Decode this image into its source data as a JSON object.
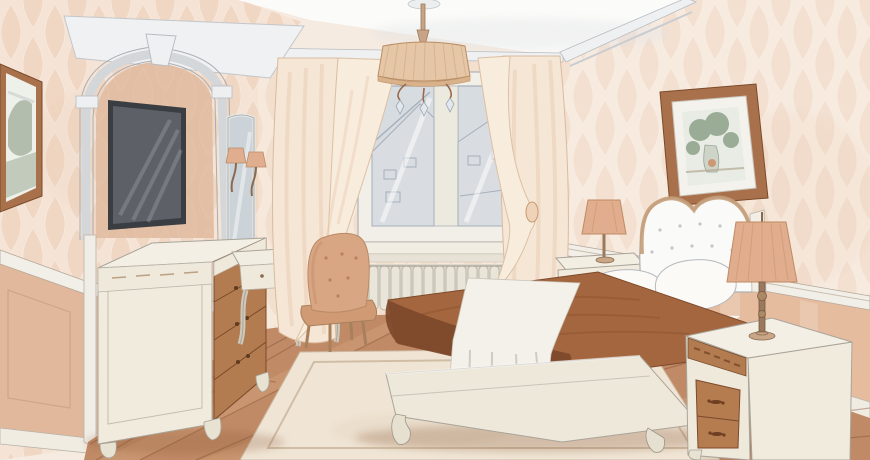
{
  "meta": {
    "type": "illustration",
    "medium": "watercolor and ink interior sketch",
    "subject": "classic bedroom interior design rendering in warm peach, cream and brown tones"
  },
  "colors": {
    "ceiling": "#fbfbf9",
    "cornice": "#eef0f1",
    "wall_left": "#f5e4d6",
    "wall_back": "#f6e8db",
    "wall_right": "#f7ebe0",
    "wallpaper_motif": "#e9c3a7",
    "wainscot": "#e2b89c",
    "wainscot_right": "#e6bc9f",
    "molding": "#f2efe8",
    "baseboard": "#f0ece2",
    "pediment": "#f0f1f2",
    "arch_panel": "#e2bfa4",
    "tv_frame": "#3a3d42",
    "tv_screen": "#5d6167",
    "mirror_glass": "#ccd3d8",
    "window_frame": "#f2efe8",
    "window_glass": "#d7dce1",
    "glass_sketch": "#a6afba",
    "radiator": "#e9e5d9",
    "curtain": "#f5e6d6",
    "curtain_deep": "#ecd0b6",
    "chandelier_shade": "#e5c6a7",
    "floor": "#c18a66",
    "floor_seam": "#7d4f33",
    "floor_light": "#d8ac85",
    "rug": "#f0e5d5",
    "coverlet": "#a4663e",
    "coverlet_dark": "#7e4a2b",
    "linen": "#f8f5ef",
    "headboard": "#fafaf8",
    "furniture_cream": "#f1ebdd",
    "furniture_wood": "#b37c50",
    "lamp_shade": "#e0ae8e",
    "chair_fabric": "#d8a683",
    "frame_wood": "#a8714b",
    "art_green": "#8da288",
    "outline": "#8e9094"
  },
  "scene": {
    "objects": [
      "white ceiling with crown cornice",
      "peach ogee-patterned wallpaper walls",
      "dado rail and darker peach wainscoting",
      "arched wall niche with keystone",
      "wall-mounted flat-screen TV in niche",
      "framed landscape picture on left wall",
      "tall vanity mirror with two candle sconces",
      "white dressing table with cabriole legs",
      "tufted upholstered chair",
      "cream chest of drawers with wooden drawer fronts",
      "double casement window with sketched city view",
      "sheer tied-back curtains",
      "column radiator under windowsill",
      "drum-shade chandelier with crystal drops",
      "double bed with white tufted headboard",
      "brown coverlet with white throw runner",
      "two white pillows",
      "two cream nightstands with wooden drawers",
      "two table lamps with pleated peach shades",
      "framed still-life picture on right wall",
      "wood plank floor",
      "cream bordered area rug"
    ]
  }
}
